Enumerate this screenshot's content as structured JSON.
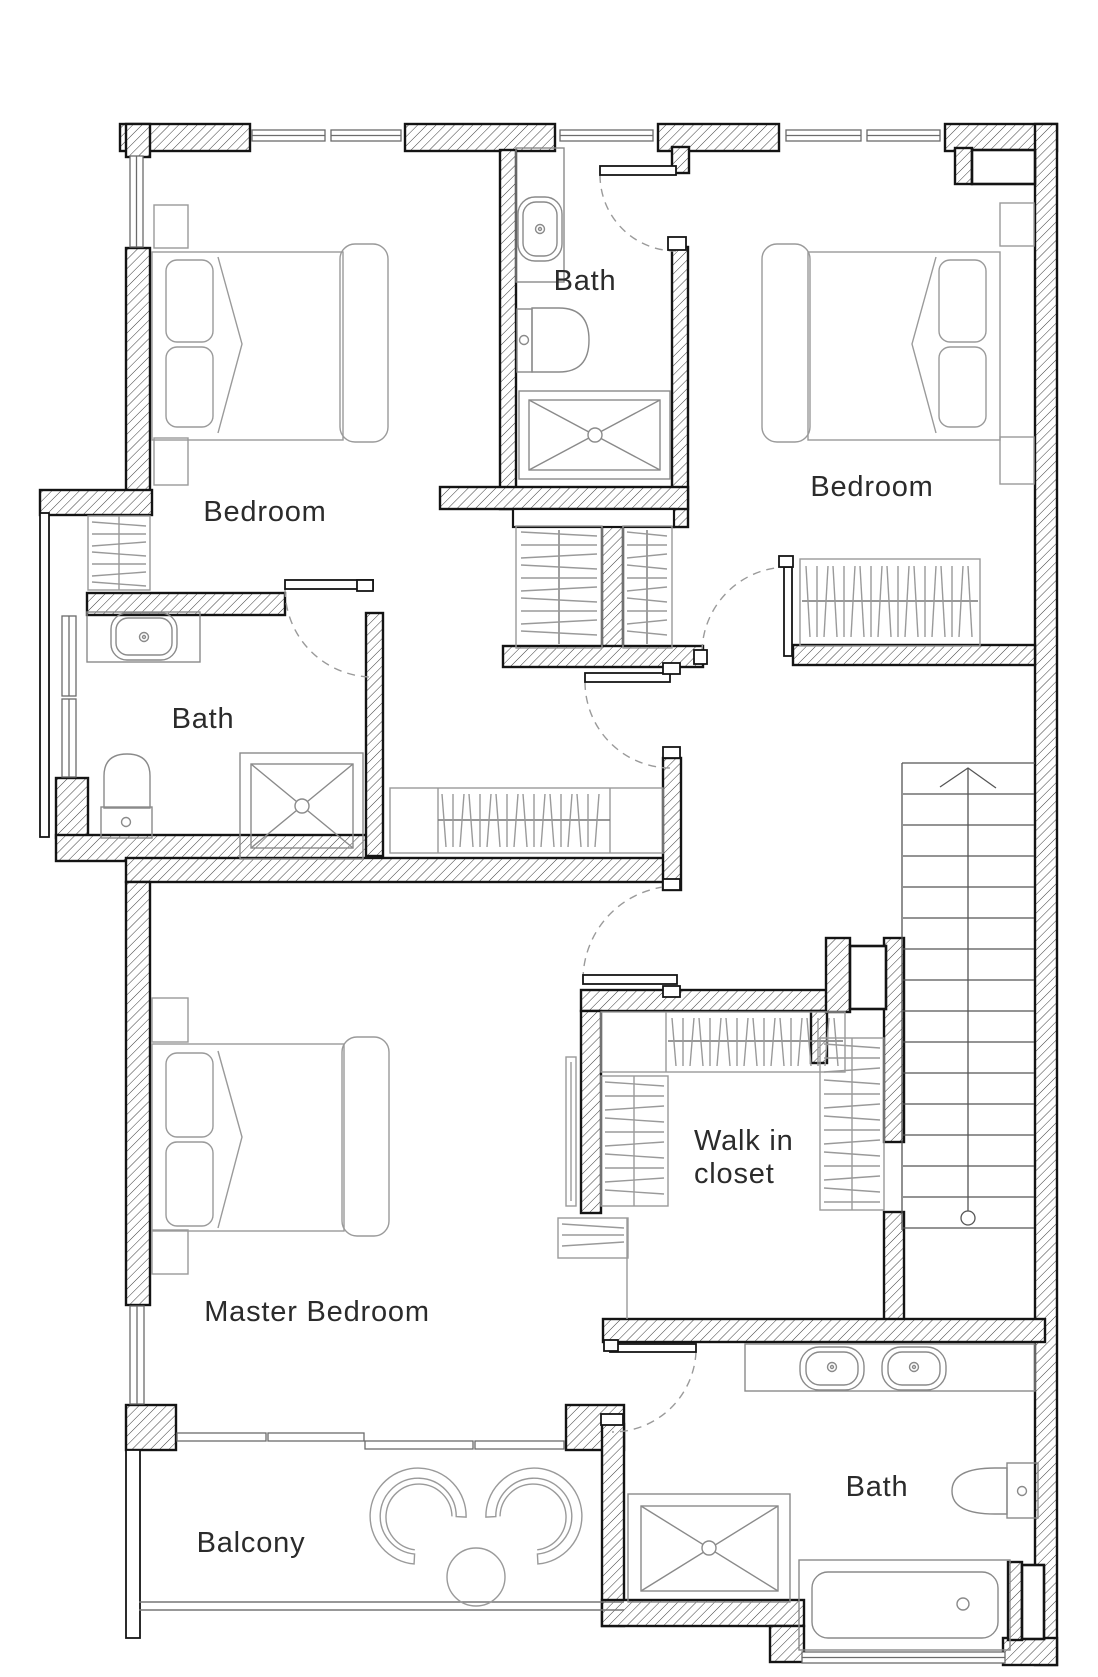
{
  "rooms": {
    "bedroom_top_left": "Bedroom",
    "bath_top": "Bath",
    "bedroom_top_right": "Bedroom",
    "bath_left": "Bath",
    "master_bedroom": "Master Bedroom",
    "walk_in_closet_line1": "Walk in",
    "walk_in_closet_line2": "closet",
    "bath_bottom": "Bath",
    "balcony": "Balcony"
  },
  "palette": {
    "wall_outline": "#141414",
    "hatch_line": "#3c3c3c",
    "furniture_line": "#9a9a9a",
    "stair_line": "#555555",
    "text_color": "#2b2b2b",
    "background": "#ffffff"
  }
}
